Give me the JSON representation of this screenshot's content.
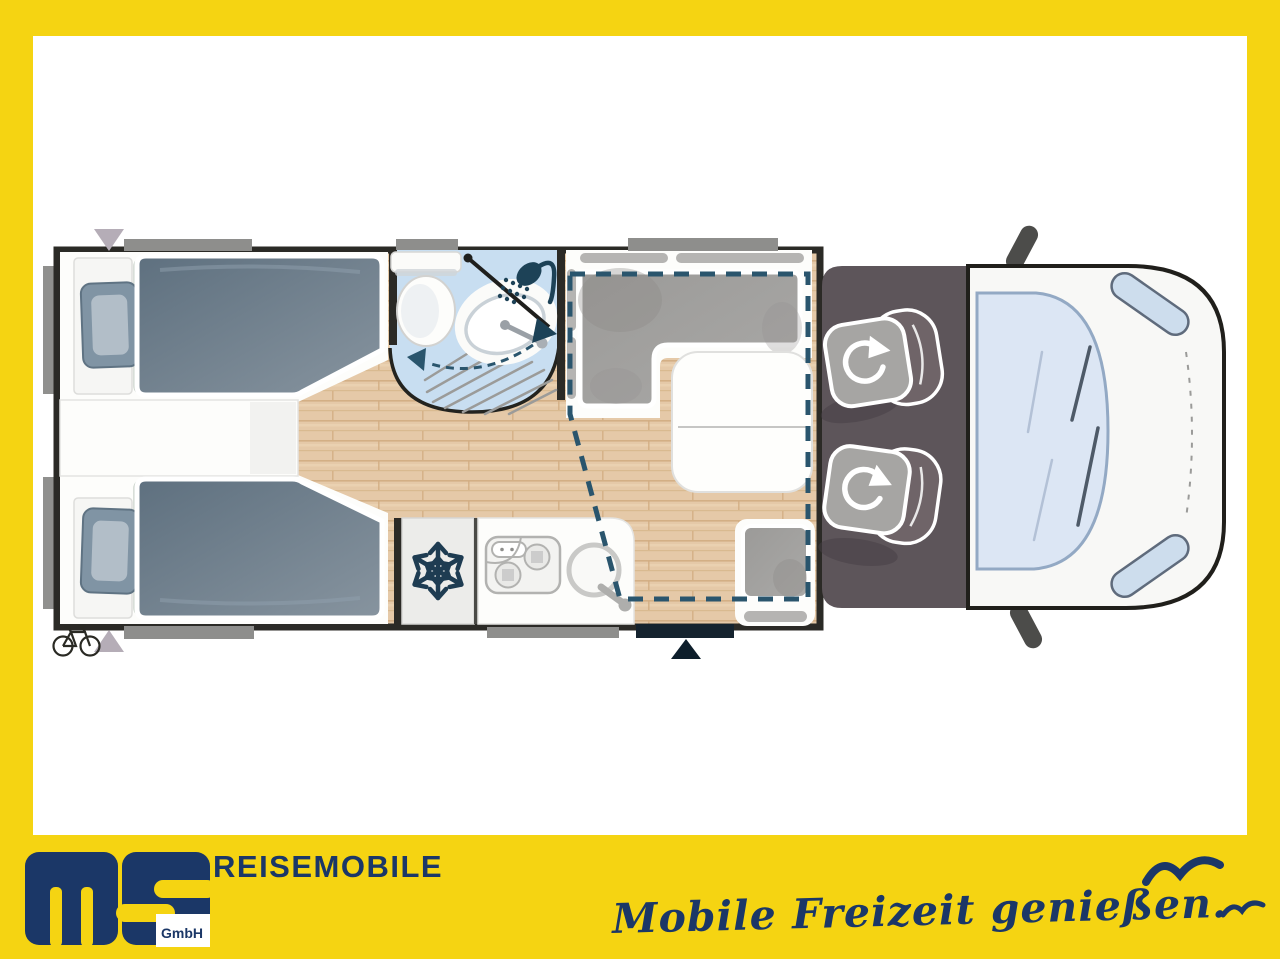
{
  "branding": {
    "logo_suffix": "GmbH",
    "wordmark": "REISEMOBILE",
    "tagline": "Mobile Freizeit genießen.",
    "colors": {
      "yellow": "#F5D412",
      "navy": "#1B3767",
      "dash_navy": "#2A556D"
    }
  },
  "floorplan": {
    "view": "motorhome top view",
    "rooms": [
      "twin-single-beds-bedroom",
      "swivel-wall-bathroom",
      "kitchen-with-fridge",
      "l-shaped-dinette-lounge",
      "driver-cab-with-swivel-seats",
      "vehicle-front"
    ],
    "icons": [
      {
        "name": "snowflake-icon",
        "meaning": "refrigerator",
        "glyph": "❄"
      },
      {
        "name": "shower-icon",
        "meaning": "shower head"
      },
      {
        "name": "swivel-arrow-icon",
        "meaning": "rotating cab seat",
        "glyph": "⟳"
      },
      {
        "name": "bicycle-icon",
        "meaning": "bike storage at rear",
        "glyph": "🚲"
      },
      {
        "name": "entry-triangle-icon",
        "meaning": "entrance door marker",
        "glyph": "▲"
      },
      {
        "name": "rear-triangle-icon",
        "meaning": "rear access markers",
        "glyph": "▼"
      },
      {
        "name": "seagull-icon",
        "meaning": "decorative birds"
      }
    ]
  }
}
